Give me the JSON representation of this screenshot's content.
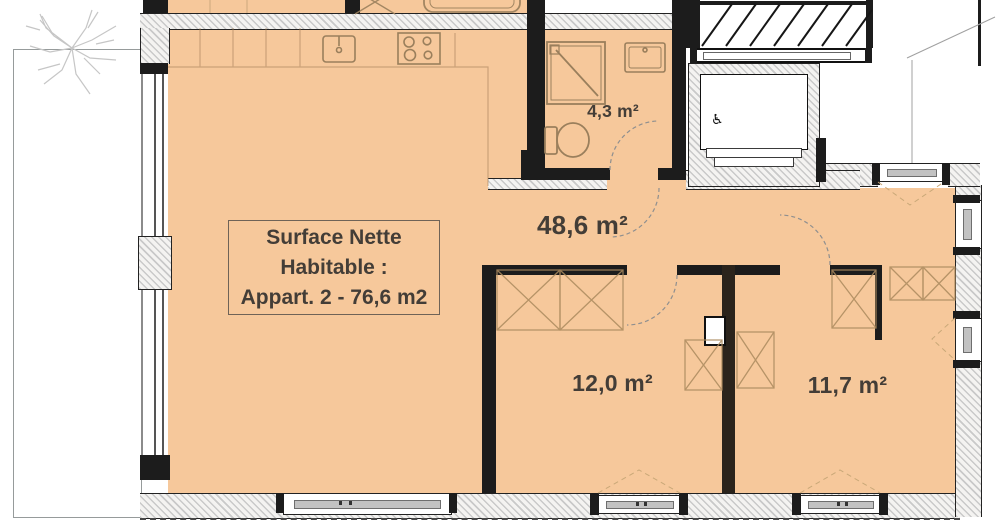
{
  "title": "Floor plan - Apartment 2",
  "surface_box": {
    "line1": "Surface Nette",
    "line2": "Habitable :",
    "line3": "Appart. 2 - 76,6 m2"
  },
  "rooms": {
    "bathroom": {
      "area_label": "4,3 m²"
    },
    "living_kitchen": {
      "area_label": "48,6 m²"
    },
    "bedroom_1": {
      "area_label": "12,0 m²"
    },
    "bedroom_2": {
      "area_label": "11,7 m²"
    }
  },
  "icons": {
    "wheelchair": "♿",
    "stove": "four-burner-circles",
    "kitchen_sink": "rect-with-faucet-dot",
    "shower": "square-with-diagonal",
    "bathroom_sink": "double-rect-with-faucet",
    "toilet": "tank-and-bowl",
    "bathtub": "rounded-rect",
    "wardrobe": "crossed-box",
    "stairs": "diagonal-treads",
    "tree": "scribble-branches"
  },
  "colors": {
    "floor_fill": "#F6C89B",
    "wall": "#1C1C1C",
    "fixture_outline": "#9A7F5C",
    "text": "#433D37"
  }
}
